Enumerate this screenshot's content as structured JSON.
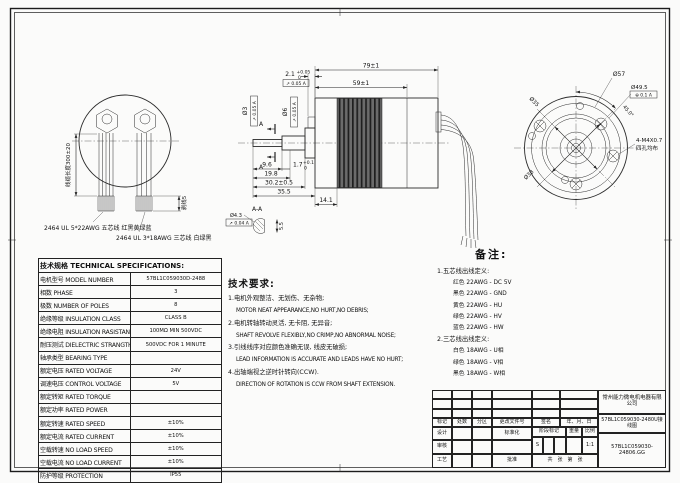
{
  "views": {
    "rear": {
      "cable_length_label": "线缆长度300±20",
      "strip_label": "剥线5",
      "cable5_label": "2464 UL 5*22AWG  五芯线 红黑黄绿蓝",
      "cable3_label": "2464 UL 3*18AWG  三芯线 白绿黑"
    },
    "side": {
      "d_overall": "79±1",
      "d_body": "59±1",
      "d_step": "2.1",
      "d_step_sup": "+0.05",
      "d_step_sub": "0",
      "d_tip": "9.6",
      "d_flat": "1.7",
      "d_flat_sup": "+0.1",
      "d_flat_sub": "0",
      "d_198": "19.8",
      "d_302": "30.2±0.5",
      "d_355": "35.5",
      "d_flange": "14.1",
      "shaft_d1": "Ø3",
      "shaft_d2": "Ø6",
      "tol_step": "↗ 0.05 A",
      "tol_shaft": "↗ 0.05 A",
      "section_label": "A-A",
      "section_dia": "Ø4.3",
      "section_tol": "↗ 0.04 A",
      "section_flat": "5.5",
      "cut_mark": "A"
    },
    "front": {
      "d57": "Ø57",
      "d495": "Ø49.5",
      "tol_495": "⊕ 0.1 A",
      "angle": "45.0°",
      "holes_line1": "4-M4X0.7",
      "holes_line2": "四孔均布",
      "d35": "Ø35",
      "d38": "Ø38"
    }
  },
  "spec_table": {
    "title": "技术规格 TECHNICAL SPECIFICATIONS:",
    "rows": [
      {
        "label": "电机型号 MODEL NUMBER",
        "value": "57BL1C059030D-2488"
      },
      {
        "label": "相数 PHASE",
        "value": "3"
      },
      {
        "label": "极数 NUMBER OF POLES",
        "value": "8"
      },
      {
        "label": "绝缘等级 INSULATION CLASS",
        "value": "CLASS B"
      },
      {
        "label": "绝缘电阻 INSULATION RASISTANCE",
        "value": "100MΩ MIN 500VDC"
      },
      {
        "label": "耐压测试 DIELECTRIC STRANGTH TEST",
        "value": "500VDC FOR 1 MINUTE"
      },
      {
        "label": "轴承类型 BEARING TYPE",
        "value": ""
      },
      {
        "label": "额定电压 RATED VOLTAGE",
        "value": "24V"
      },
      {
        "label": "调速电压 CONTROL VOLTAGE",
        "value": "5V"
      },
      {
        "label": "额定转矩 RATED TORQUE",
        "value": ""
      },
      {
        "label": "额定功率 RATED POWER",
        "value": ""
      },
      {
        "label": "额定转速 RATED SPEED",
        "value": "±10%"
      },
      {
        "label": "额定电流 RATED CURRENT",
        "value": "±10%"
      },
      {
        "label": "空载转速 NO LOAD SPEED",
        "value": "±10%"
      },
      {
        "label": "空载电流 NO LOAD CURRENT",
        "value": "±10%"
      },
      {
        "label": "防护等级 PROTECTION",
        "value": "IP55"
      }
    ]
  },
  "tech_req": {
    "title": "技术要求:",
    "items": [
      {
        "cn": "1.电机外观整洁、无划伤、无杂物;",
        "en": "MOTOR NEAT APPEARANCE,NO HURT,NO DEBRIS;"
      },
      {
        "cn": "2.电机转轴转动灵活, 无卡阻, 无异音;",
        "en": "SHAFT REVOLVE FLEXIBLY,NO CRIMP,NO ABNORMAL NOISE;"
      },
      {
        "cn": "3.引线线序对应颜色准确无误, 线皮无破损;",
        "en": "LEAD INFORMATION IS ACCURATE AND LEADS HAVE NO HURT;"
      },
      {
        "cn": "4.出轴端视之逆时针转向(CCW).",
        "en": "DIRECTION OF ROTATION IS CCW FROM SHAFT EXTENSION."
      }
    ]
  },
  "remarks": {
    "title": "备注:",
    "group1_title": "1.五芯线出线定义:",
    "group1": [
      "红色 22AWG - DC 5V",
      "黑色 22AWG - GND",
      "黄色 22AWG - HU",
      "绿色 22AWG - HV",
      "蓝色 22AWG - HW"
    ],
    "group2_title": "2.三芯线出线定义:",
    "group2": [
      "白色 18AWG - U相",
      "绿色 18AWG - V相",
      "黑色 18AWG - W相"
    ]
  },
  "title_block": {
    "company": "常州能力微电机电器有限公司",
    "drawing_name": "57BL1C059030-2480U接线图",
    "part_no": "57BL1C059030-24806.GG",
    "labels": {
      "mark": "标记",
      "count": "处数",
      "zone": "分区",
      "doc_no": "更改文件号",
      "sign": "签名",
      "date": "年、月、日",
      "design": "设计",
      "standard": "标准化",
      "stage_mark": "阶段标记",
      "weight": "重量",
      "scale": "比例",
      "check": "审核",
      "process": "工艺",
      "approve": "批准"
    },
    "stage_value": "S",
    "scale_value": "1:1",
    "sheet_note": "共　张　第　张"
  }
}
